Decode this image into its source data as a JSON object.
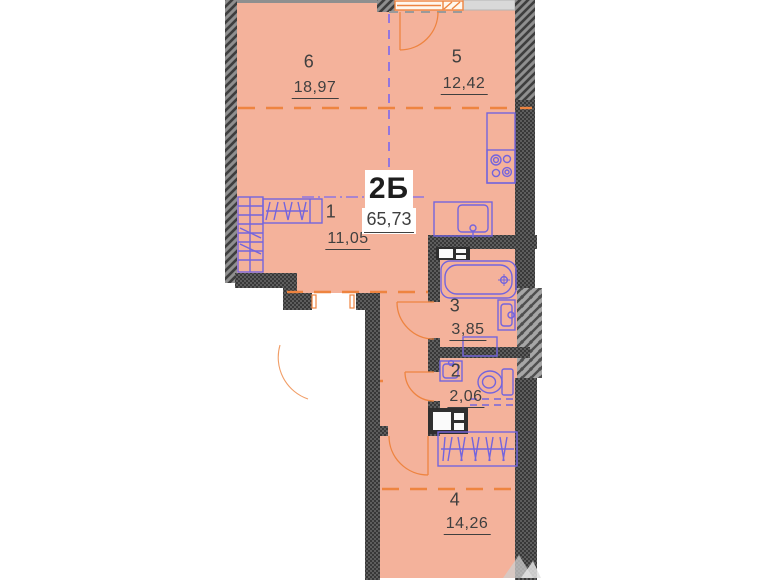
{
  "apartment": {
    "type_label": "2Б",
    "total_area": "65,73"
  },
  "rooms": [
    {
      "number": "6",
      "area": "18,97"
    },
    {
      "number": "5",
      "area": "12,42"
    },
    {
      "number": "1",
      "area": "11,05"
    },
    {
      "number": "3",
      "area": "3,85"
    },
    {
      "number": "2",
      "area": "2,06"
    },
    {
      "number": "4",
      "area": "14,26"
    }
  ],
  "colors": {
    "floor_fill": "#f4b29b",
    "wall_dark": "#3f3f3f",
    "zone_line_orange": "#ee8440",
    "fixture_purple": "#7464dd",
    "divider_purple": "#7b68ee"
  }
}
